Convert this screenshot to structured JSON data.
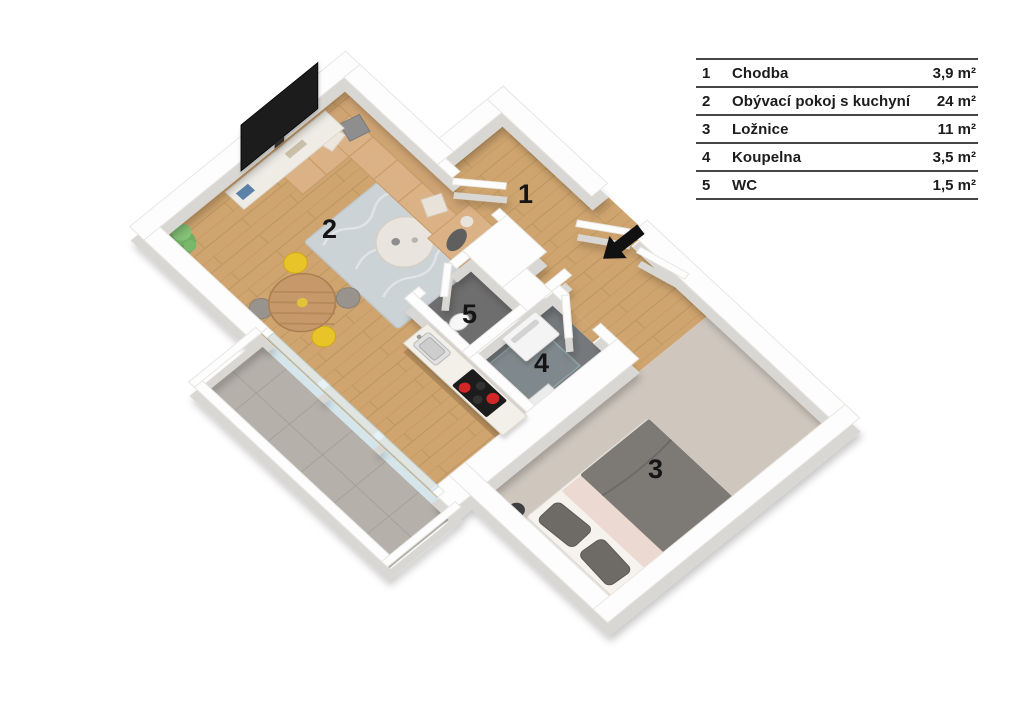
{
  "legend": {
    "rows": [
      {
        "num": "1",
        "name": "Chodba",
        "area": "3,9 m²"
      },
      {
        "num": "2",
        "name": "Obývací pokoj s kuchyní",
        "area": "24 m²"
      },
      {
        "num": "3",
        "name": "Ložnice",
        "area": "11 m²"
      },
      {
        "num": "4",
        "name": "Koupelna",
        "area": "3,5 m²"
      },
      {
        "num": "5",
        "name": "WC",
        "area": "1,5 m²"
      }
    ]
  },
  "floor_plan": {
    "room_labels": {
      "hallway": "1",
      "living_room": "2",
      "bedroom": "3",
      "bathroom": "4",
      "wc": "5"
    },
    "furniture": [
      "tv",
      "tv-stand",
      "plant",
      "rug",
      "coffee-table",
      "corner-sofa",
      "pillows",
      "dining-table",
      "yellow-chairs",
      "gray-chairs",
      "kitchen-counter",
      "sink",
      "cooktop",
      "shower",
      "washing-machine",
      "toilet",
      "double-bed",
      "bedside-lamps",
      "balcony-windows",
      "entrance-door"
    ],
    "colors": {
      "wood_floor": "#cfa46e",
      "balcony_tile": "#b5b0aa",
      "bedroom_carpet": "#cfc7be",
      "wc_floor": "#6e6e6e",
      "bath_floor": "#75797c",
      "wall_top": "#fdfdfd",
      "wall_side": "#d9d7d4",
      "rug": "#ccd3d6",
      "sofa": "#dbb286",
      "chair_yellow": "#e9c428",
      "chair_gray": "#98938c",
      "burner_red": "#d32626",
      "duvet_gray": "#7d7974",
      "blanket_blush": "#ecd9d2",
      "glass": "#cfe3ea",
      "arrow": "#111111"
    }
  }
}
